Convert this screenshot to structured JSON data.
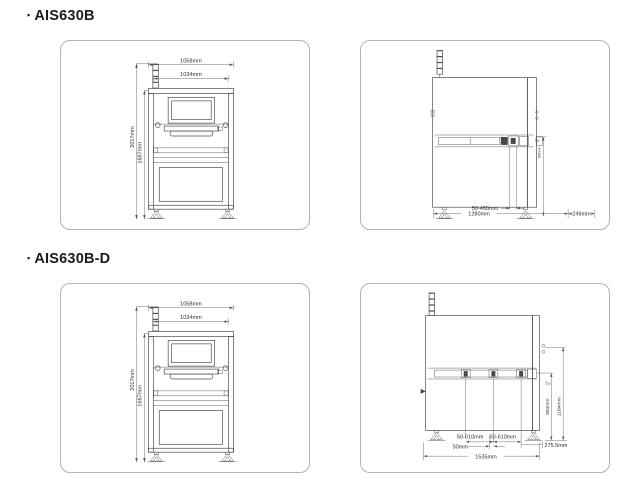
{
  "colors": {
    "line": "#4c4c4c",
    "dim_line": "#5f5f5f",
    "panel_border": "#b3b3b3",
    "text": "#2e2e2e",
    "background": "#ffffff"
  },
  "sections": [
    {
      "bullet": "▪",
      "title": "AIS630B",
      "front": {
        "width_outer": "1058mm",
        "width_inner": "1034mm",
        "height_total": "2017mm",
        "height_inner": "1667mm"
      },
      "side": {
        "conveyor_height": "900mm",
        "tol_plus": "+100",
        "tol_minus": "-20",
        "pcb_width_range": "50-460mm",
        "depth_total": "1280mm",
        "rear_clearance": "249mm"
      }
    },
    {
      "bullet": "▪",
      "title": "AIS630B-D",
      "front": {
        "width_outer": "1058mm",
        "width_inner": "1034mm",
        "height_total": "2017mm",
        "height_inner": "1667mm"
      },
      "side": {
        "lane1_width_range": "50-610mm",
        "lane2_width_range": "50-610mm",
        "center_rail_width": "50mm",
        "depth_total": "1535mm",
        "rear_clearance": "275.5mm",
        "conveyor_height": "900mm",
        "tol_plus": "+100",
        "tol_minus": "-20",
        "height_to_conveyor_top": "1184mm"
      }
    }
  ]
}
